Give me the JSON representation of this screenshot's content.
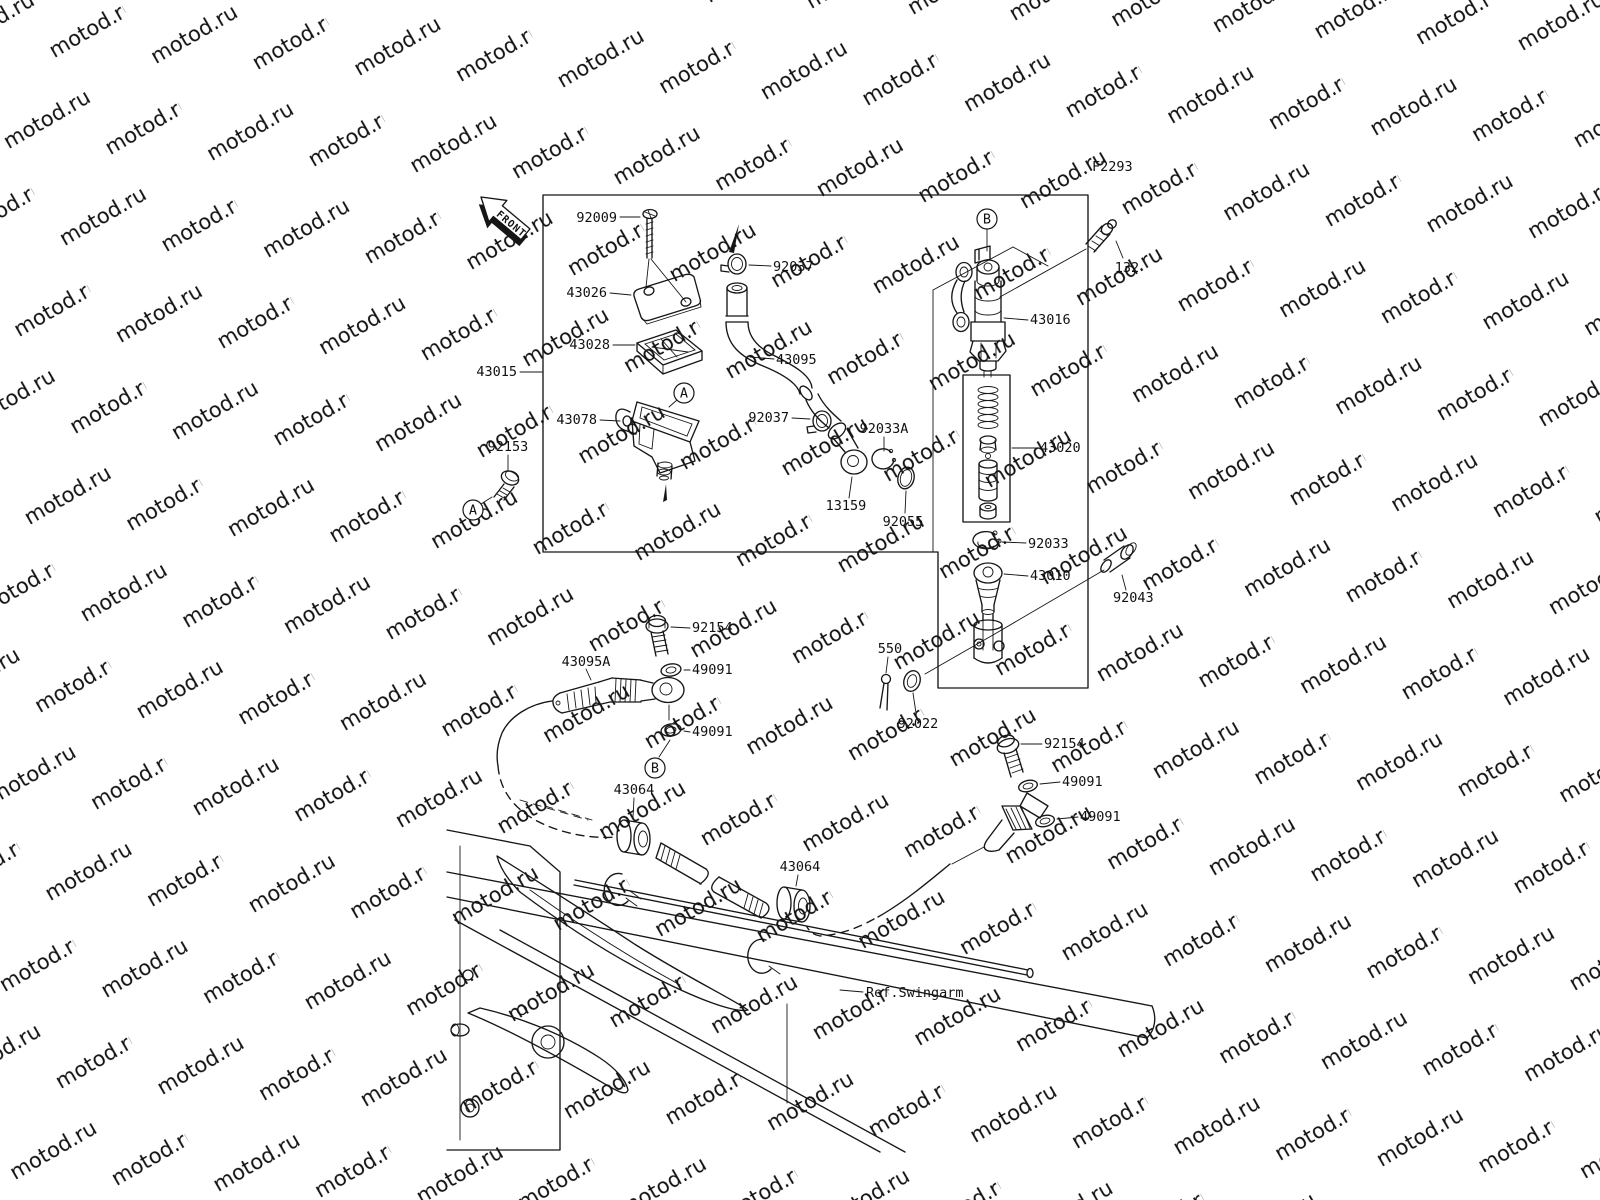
{
  "watermark": {
    "text": "motod.ru",
    "color": "#d6d6d6"
  },
  "figure_code": "F2293",
  "front_arrow_label": "FRONT",
  "ref_label": "Ref.Swingarm",
  "markers": {
    "a": "A",
    "b": "B"
  },
  "callouts": {
    "screw_92009": "92009",
    "cap_43026": "43026",
    "plate_43028": "43028",
    "assy_43015": "43015",
    "reservoir_43078": "43078",
    "bolt_92153": "92153",
    "clamp_92037_upper": "92037",
    "hose_43095": "43095",
    "clamp_92037_lower": "92037",
    "ring_92033a": "92033A",
    "fitting_13159": "13159",
    "oring_92055": "92055",
    "cylinder_43016": "43016",
    "bolt_132": "132",
    "kit_43020": "43020",
    "ring_92033": "92033",
    "rod_43010": "43010",
    "pin_92043": "92043",
    "cotter_550": "550",
    "washer_92022": "92022",
    "bolt_92154_left": "92154",
    "washer_49091_left_upper": "49091",
    "hose_43095a": "43095A",
    "washer_49091_left_lower": "49091",
    "grommet_43064_left": "43064",
    "grommet_43064_right": "43064",
    "bolt_92154_right": "92154",
    "washer_49091_right_upper": "49091",
    "washer_49091_right_lower": "49091"
  }
}
